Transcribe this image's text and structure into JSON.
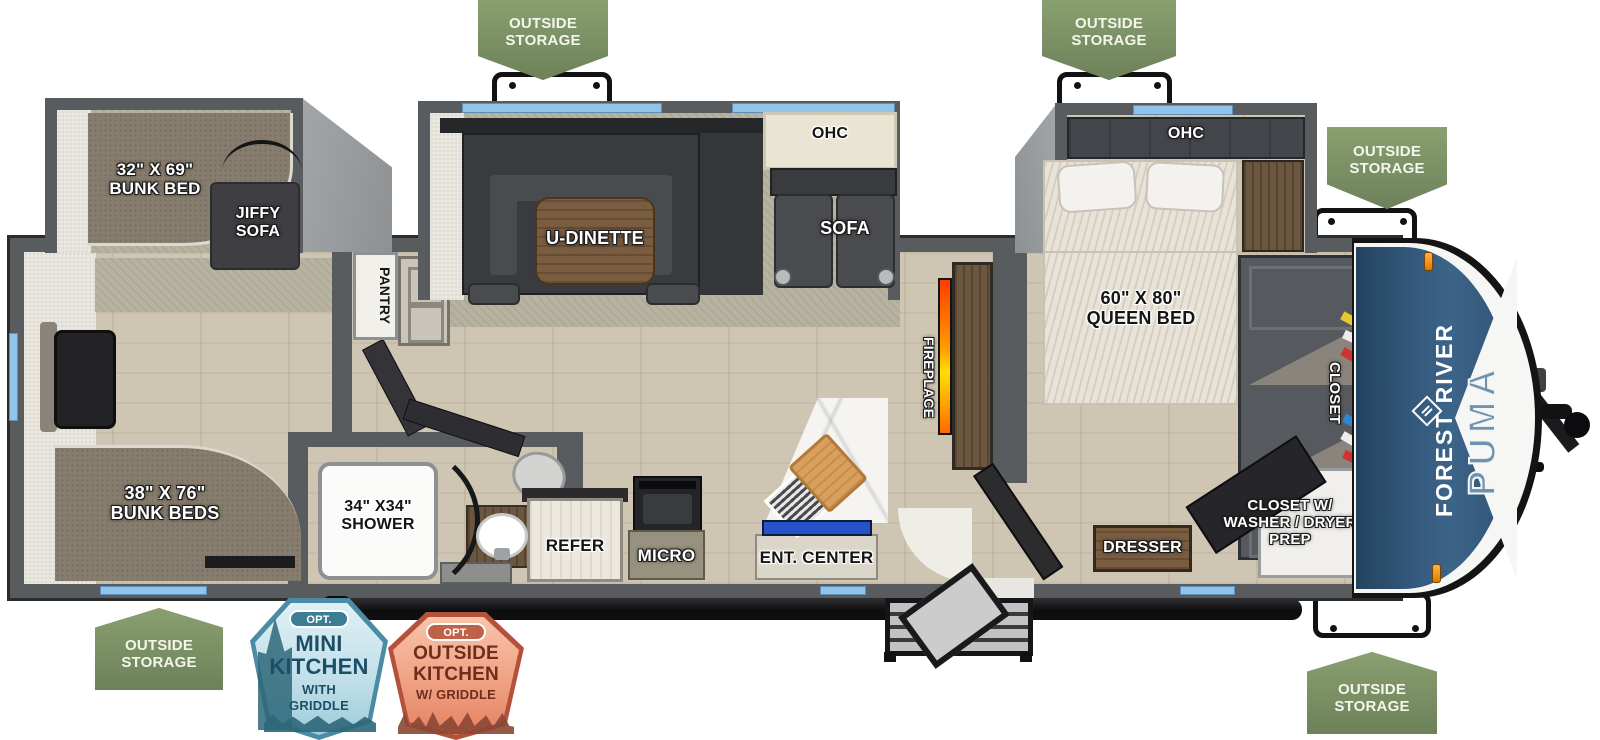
{
  "colors": {
    "badge_green": "#7d9166",
    "option_blue": "#4b8ba4",
    "option_orange": "#bf6248",
    "cap_blue": "#33587b",
    "window_blue": "#92c3e8",
    "fireplace_orange": "#ff8c00",
    "wall_gray": "#595c5e"
  },
  "badges": {
    "outside_storage": "OUTSIDE\nSTORAGE"
  },
  "option_badges": {
    "mini_kitchen": {
      "opt": "OPT.",
      "title": "MINI\nKITCHEN",
      "subtitle": "WITH\nGRIDDLE"
    },
    "outside_kitchen": {
      "opt": "OPT.",
      "title": "OUTSIDE\nKITCHEN",
      "subtitle": "W/ GRIDDLE"
    }
  },
  "brand": {
    "manufacturer": "FOREST RIVER",
    "model": "PUMA"
  },
  "labels": {
    "bunk_slide_bed": "32\" X 69\"\nBUNK BED",
    "jiffy_sofa": "JIFFY\nSOFA",
    "pantry": "PANTRY",
    "u_dinette": "U-DINETTE",
    "ohc_dinette": "OHC",
    "sofa": "SOFA",
    "ohc_bedroom": "OHC",
    "queen_bed": "60\" X 80\"\nQUEEN BED",
    "fireplace": "FIREPLACE",
    "shower": "34\" X34\"\nSHOWER",
    "refer": "REFER",
    "micro": "MICRO",
    "ent_center": "ENT. CENTER",
    "rear_bunks": "38\" X 76\"\nBUNK BEDS",
    "dresser": "DRESSER",
    "closet": "CLOSET",
    "closet_washer_dryer": "CLOSET W/\nWASHER / DRYER\nPREP"
  }
}
